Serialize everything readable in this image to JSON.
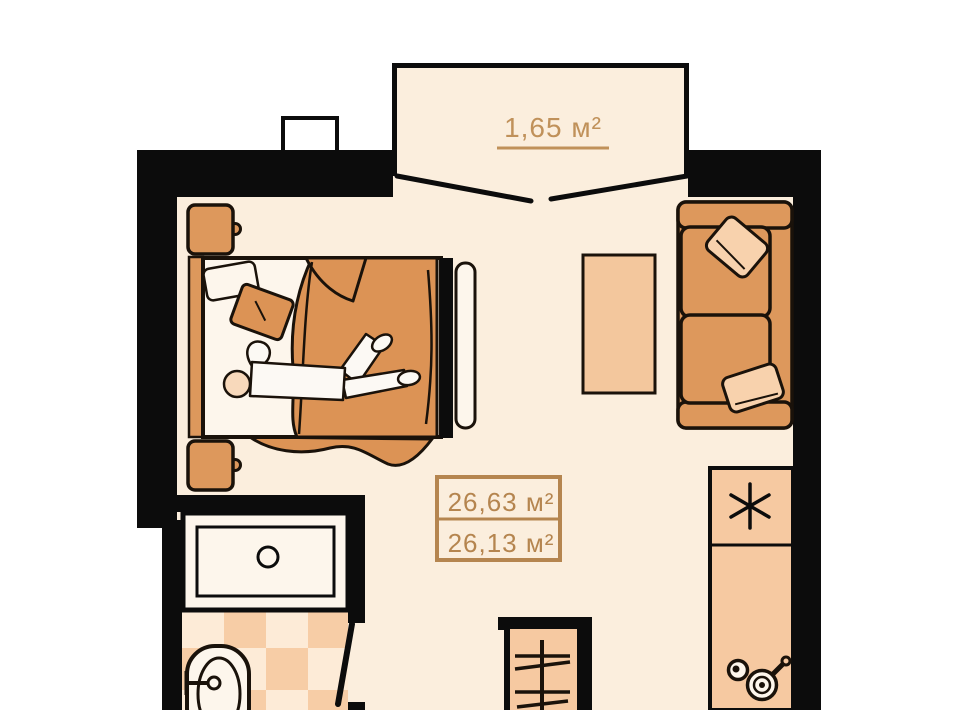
{
  "labels": {
    "balcony_area": "1,65 м²",
    "total_area": "26,63 м²",
    "living_area": "26,13 м²"
  },
  "colors": {
    "wall": "#0c0c0c",
    "floor": "#fbeedd",
    "outside": "#ffffff",
    "furniture_orange": "#dd985c",
    "blanket_orange": "#dc9355",
    "peach": "#f6c9a1",
    "pillow_peach": "#f8d2ad",
    "tile_dark": "#f7cda6",
    "tile_light": "#fdebd7",
    "fixture_white": "#fdf6ec",
    "skin": "#f8d9bb",
    "label_brown": "#b5854f",
    "balcony_label_brown": "#c0915a",
    "outline": "#1a120a"
  },
  "icons": {
    "fridge_symbol": "six-spoke asterisk",
    "stove_symbol": "two burner circles with pan handle",
    "wardrobe_symbol": "rail with hangers",
    "shower_symbol": "tray with drain circle",
    "door_symbol": "swing leaf line"
  }
}
